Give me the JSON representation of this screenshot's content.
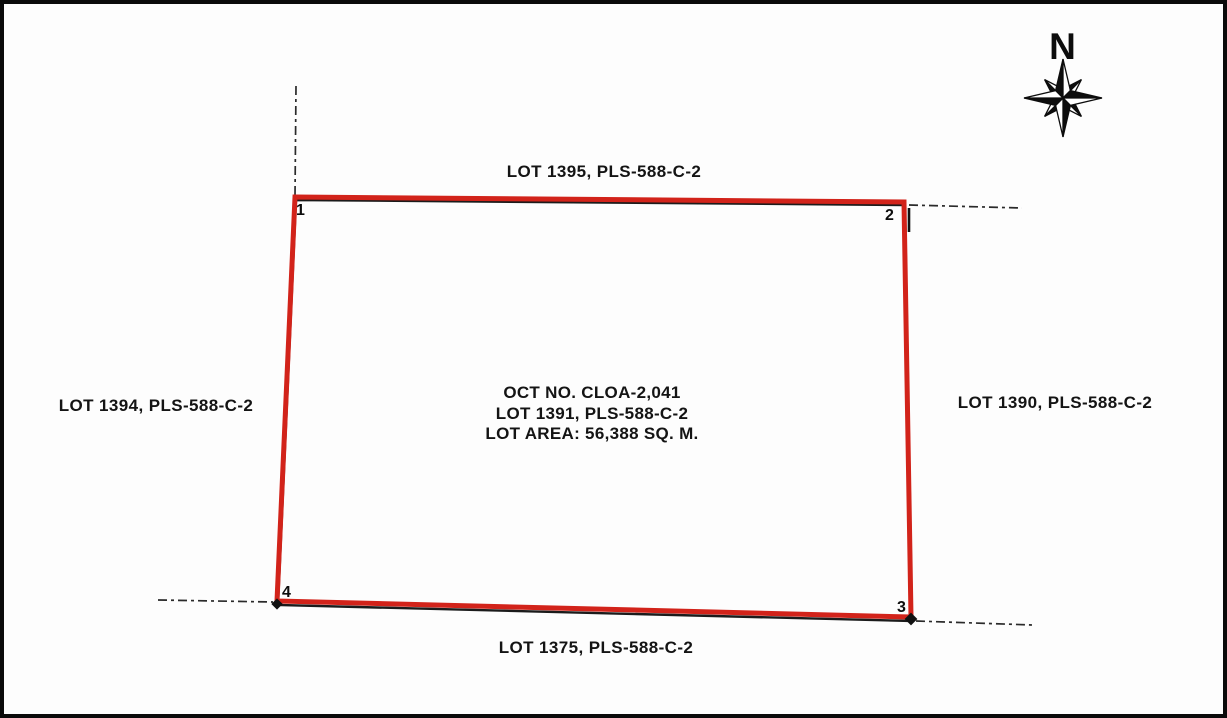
{
  "meta": {
    "type": "cadastral-sketch-plan",
    "background": "#fdfdfd",
    "frame_color": "#0a0a0a",
    "boundary_color": "#d2231a",
    "ink_color": "#1b1b1b"
  },
  "compass": {
    "label": "N"
  },
  "parcel": {
    "center_lines": [
      "OCT NO. CLOA-2,041",
      "LOT 1391, PLS-588-C-2",
      "LOT AREA: 56,388 SQ. M."
    ],
    "corner_labels": [
      "1",
      "2",
      "3",
      "4"
    ]
  },
  "adjacent_lots": {
    "top": "LOT 1395, PLS-588-C-2",
    "left": "LOT 1394, PLS-588-C-2",
    "right": "LOT 1390, PLS-588-C-2",
    "bottom": "LOT 1375, PLS-588-C-2"
  }
}
